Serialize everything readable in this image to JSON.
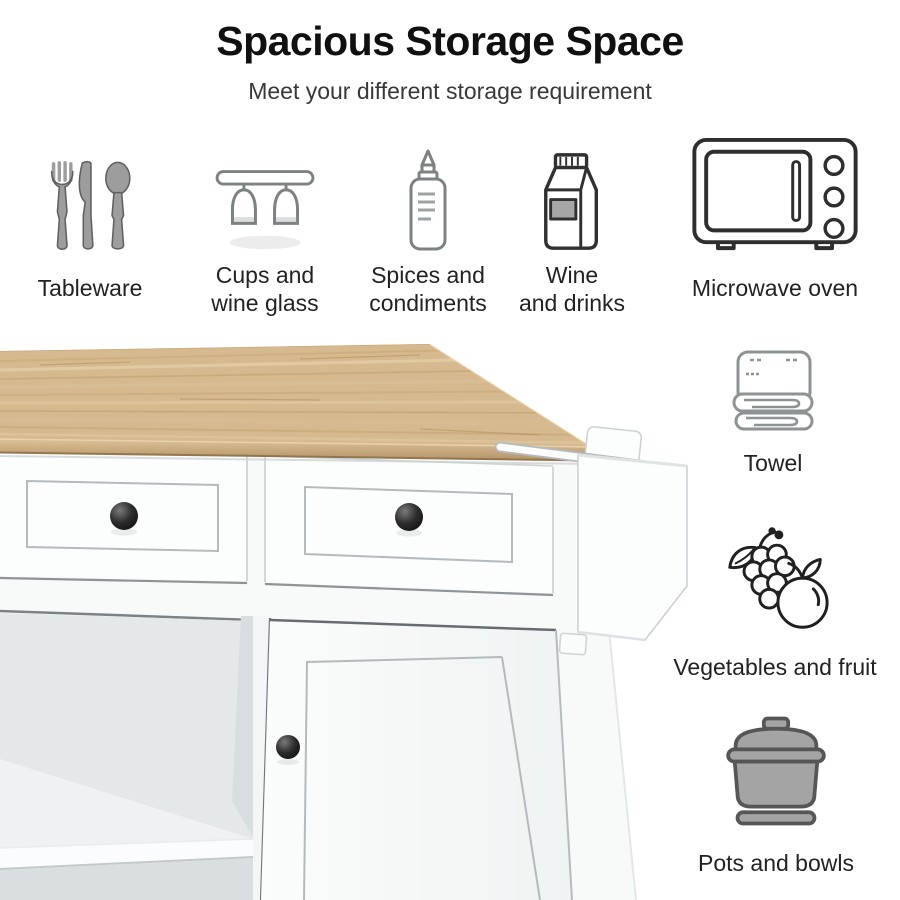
{
  "header": {
    "title": "Spacious Storage Space",
    "subtitle": "Meet your different storage requirement"
  },
  "features_top": [
    {
      "icon": "tableware-icon",
      "label": "Tableware"
    },
    {
      "icon": "wine-glass-rack-icon",
      "label": "Cups and\nwine glass"
    },
    {
      "icon": "condiment-bottle-icon",
      "label": "Spices and\ncondiments"
    },
    {
      "icon": "drink-carton-icon",
      "label": "Wine\nand drinks"
    },
    {
      "icon": "microwave-oven-icon",
      "label": "Microwave oven"
    }
  ],
  "features_side": [
    {
      "icon": "towel-icon",
      "label": "Towel"
    },
    {
      "icon": "vegetables-fruit-icon",
      "label": "Vegetables and fruit"
    },
    {
      "icon": "pot-icon",
      "label": "Pots and bowls"
    }
  ],
  "product_image": {
    "name": "kitchen-island-cart",
    "parts": [
      "wood-countertop",
      "left-drawer",
      "right-drawer",
      "open-shelves",
      "cabinet-door",
      "side-towel-rack"
    ]
  },
  "colors": {
    "background": "#ffffff",
    "title_text": "#101010",
    "subtitle_text": "#383838",
    "label_text": "#222222",
    "wood_top": "#d6b98e",
    "cabinet_white": "#f8fafa",
    "knob_black": "#1c1c1c"
  }
}
